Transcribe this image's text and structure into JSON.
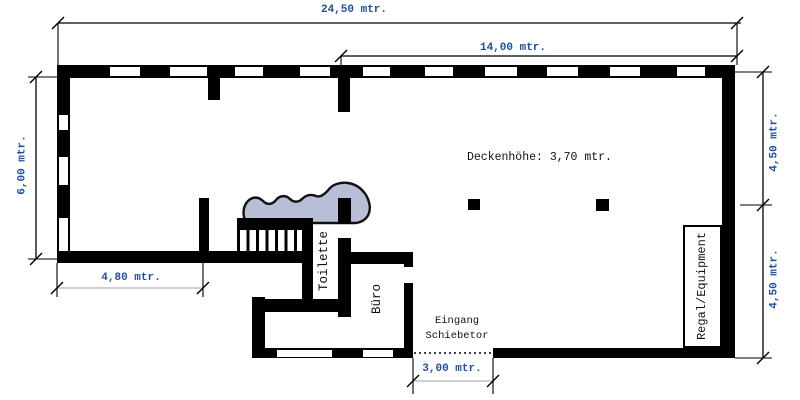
{
  "dimensions": {
    "total_width": "24,50 mtr.",
    "upper_right_width": "14,00 mtr.",
    "left_height": "6,00 mtr.",
    "lower_left_width": "4,80 mtr.",
    "right_upper_height": "4,50 mtr.",
    "right_lower_height": "4,50 mtr.",
    "entrance_width": "3,00 mtr."
  },
  "annotations": {
    "ceiling_note": "Deckenhöhe: 3,70 mtr.",
    "toilet": "Toilette",
    "office": "Büro",
    "entrance_line1": "Eingang",
    "entrance_line2": "Schiebetor",
    "shelf": "Regal/Equipment"
  },
  "colors": {
    "wall": "#000000",
    "dimension_text": "#1e4f9e",
    "dimension_line_light": "#bcc0ca",
    "stage_fill": "#b7bed5",
    "background": "#ffffff"
  }
}
